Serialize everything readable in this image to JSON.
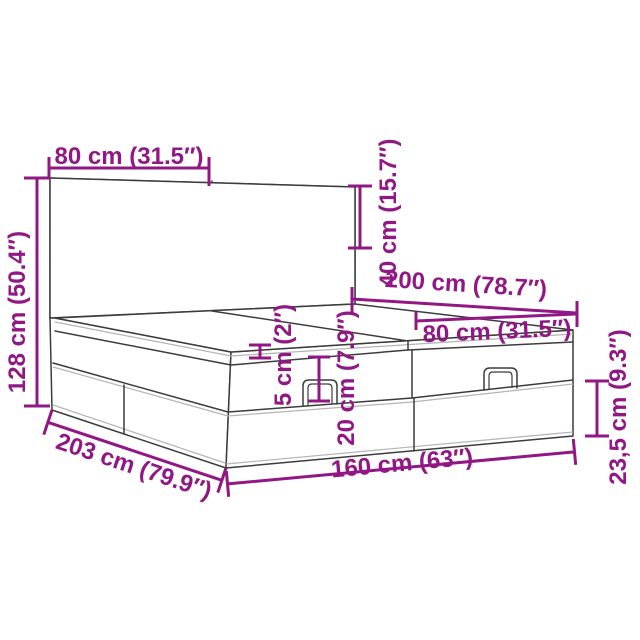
{
  "diagram": {
    "subject": "ottoman-storage-bed-with-tufted-headboard",
    "accent_color": "#911884",
    "line_color": "#3C3C3C",
    "background_color": "#FFFFFF",
    "dimensions": [
      {
        "id": "headboard-panel-width",
        "label": "80 cm (31.5″)"
      },
      {
        "id": "headboard-height-above-base",
        "label": "40 cm (15.7″)"
      },
      {
        "id": "total-height",
        "label": "128 cm (50.4″)"
      },
      {
        "id": "bed-length",
        "label": "200 cm (78.7″)"
      },
      {
        "id": "half-mattress-width",
        "label": "80 cm (31.5″)"
      },
      {
        "id": "top-pad-thickness",
        "label": "5 cm (2″)"
      },
      {
        "id": "lid-section-height",
        "label": "20 cm (7.9″)"
      },
      {
        "id": "base-section-height",
        "label": "23,5 cm (9.3″)"
      },
      {
        "id": "outer-length",
        "label": "203 cm (79.9″)"
      },
      {
        "id": "outer-width",
        "label": "160 cm (63″)"
      }
    ]
  }
}
